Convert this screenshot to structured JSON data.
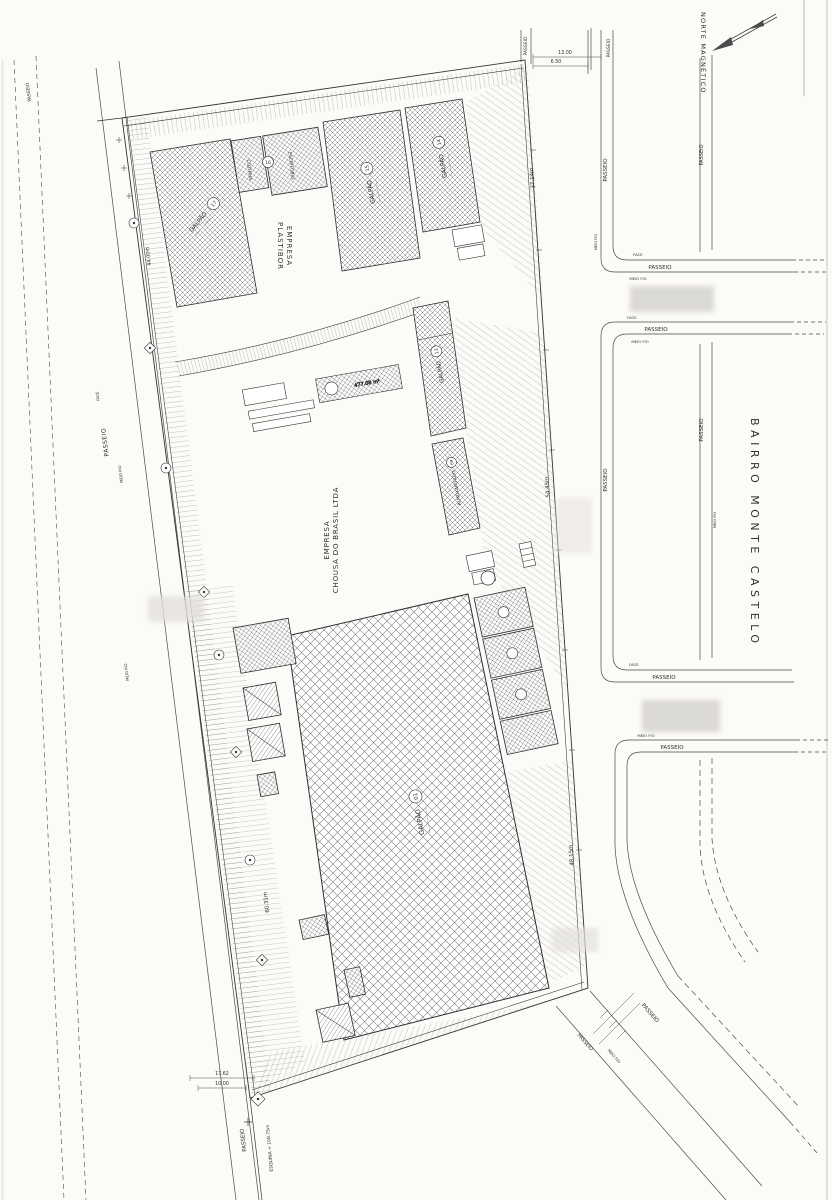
{
  "colors": {
    "paper": "#fcfbf8",
    "ink": "#3a3a3a",
    "district_gray": "#7a7a7a"
  },
  "compass": {
    "label": "NORTE MAGNÉTICO"
  },
  "district": {
    "label": "BAIRRO MONTE CASTELO"
  },
  "street": {
    "passeio": "PASSEIO",
    "meio_fio": "MEIO FIO",
    "face": "FACE"
  },
  "companies": {
    "plastibor": {
      "line1": "EMPRESA",
      "line2": "PLASTIBOR"
    },
    "chousa": {
      "line1": "EMPRESA",
      "line2": "CHOUSA DO BRASIL LTDA"
    }
  },
  "labels": {
    "galpao": "GALPÃO",
    "almoxarifado": "ALMOXARIFADO",
    "cozinha": "COZINHA",
    "escritorio": "ESCRITÓRIO"
  },
  "numbers": {
    "b17": "17",
    "b16": "16",
    "b15": "15",
    "b14": "14",
    "b13": "13",
    "b09": "09",
    "b01": "01"
  },
  "dimensions": {
    "left_upper": "44.00m",
    "left_lower": "60.31m",
    "right_upper": "37.14m",
    "right_mid": "54.45m",
    "right_lower": "48.15m",
    "street_top_a": "13.00",
    "street_top_b": "6.50",
    "bottom_a": "17.62",
    "bottom_b": "10.00",
    "bottom_corner": "ESQUINA = 108.75m",
    "platform_area": "477.08 m²"
  }
}
